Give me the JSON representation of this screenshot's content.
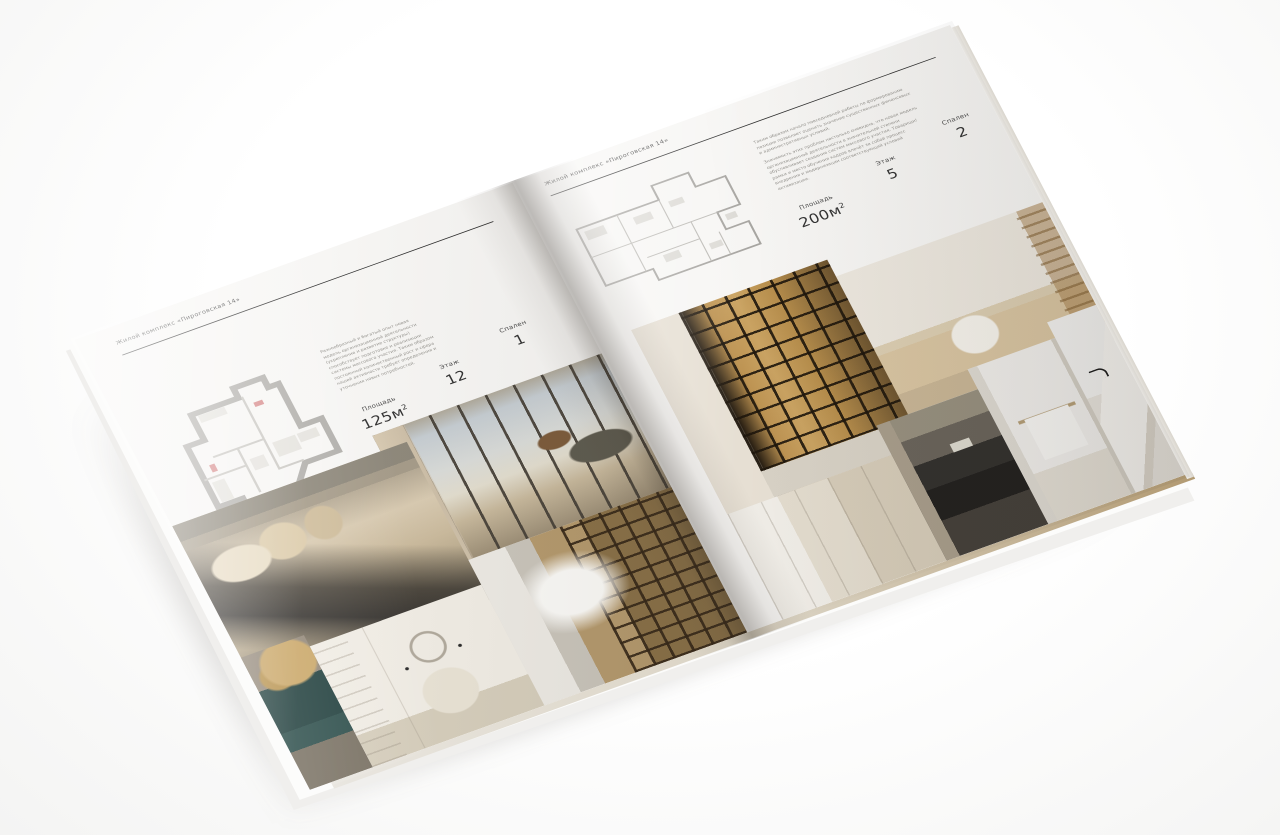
{
  "magazine": {
    "left_page": {
      "header": "Жилой комплекс «Пироговская 14»",
      "description": "Разнообразный и богатый опыт новая модель организационной деятельности (укрепление и развитие структуры) способствует подготовке и реализации системы массового участия. Таким образом постоянный количественный рост и сфера нашей активности требует определения и уточнения новых потребностей.",
      "stats": [
        {
          "label": "Площадь",
          "value": "125м",
          "sup": "2"
        },
        {
          "label": "Этаж",
          "value": "12"
        },
        {
          "label": "Спален",
          "value": "1"
        }
      ]
    },
    "right_page": {
      "header": "Жилой комплекс «Пироговская 14»",
      "description_1": "Таким образом начало повседневной работы по формированию позиции позволяет оценить значение существенных финансовых и административных условий.",
      "description_2": "Значимость этих проблем настолько очевидна, что новая модель организационной деятельности в значительной степени обусловливает создание систем массового участия. Товарищи! рамки и место обучения кадров влечёт за собой процесс внедрения и модернизации соответствующий условий активизации.",
      "stats": [
        {
          "label": "Площадь",
          "value": "200м",
          "sup": "2"
        },
        {
          "label": "Этаж",
          "value": "5"
        },
        {
          "label": "Спален",
          "value": "2"
        }
      ]
    },
    "colors": {
      "page": "#f7f6f4",
      "rule": "#2e2e2e",
      "edge_tan": "#b29a72",
      "shelf_glow": "#c9a462"
    }
  }
}
